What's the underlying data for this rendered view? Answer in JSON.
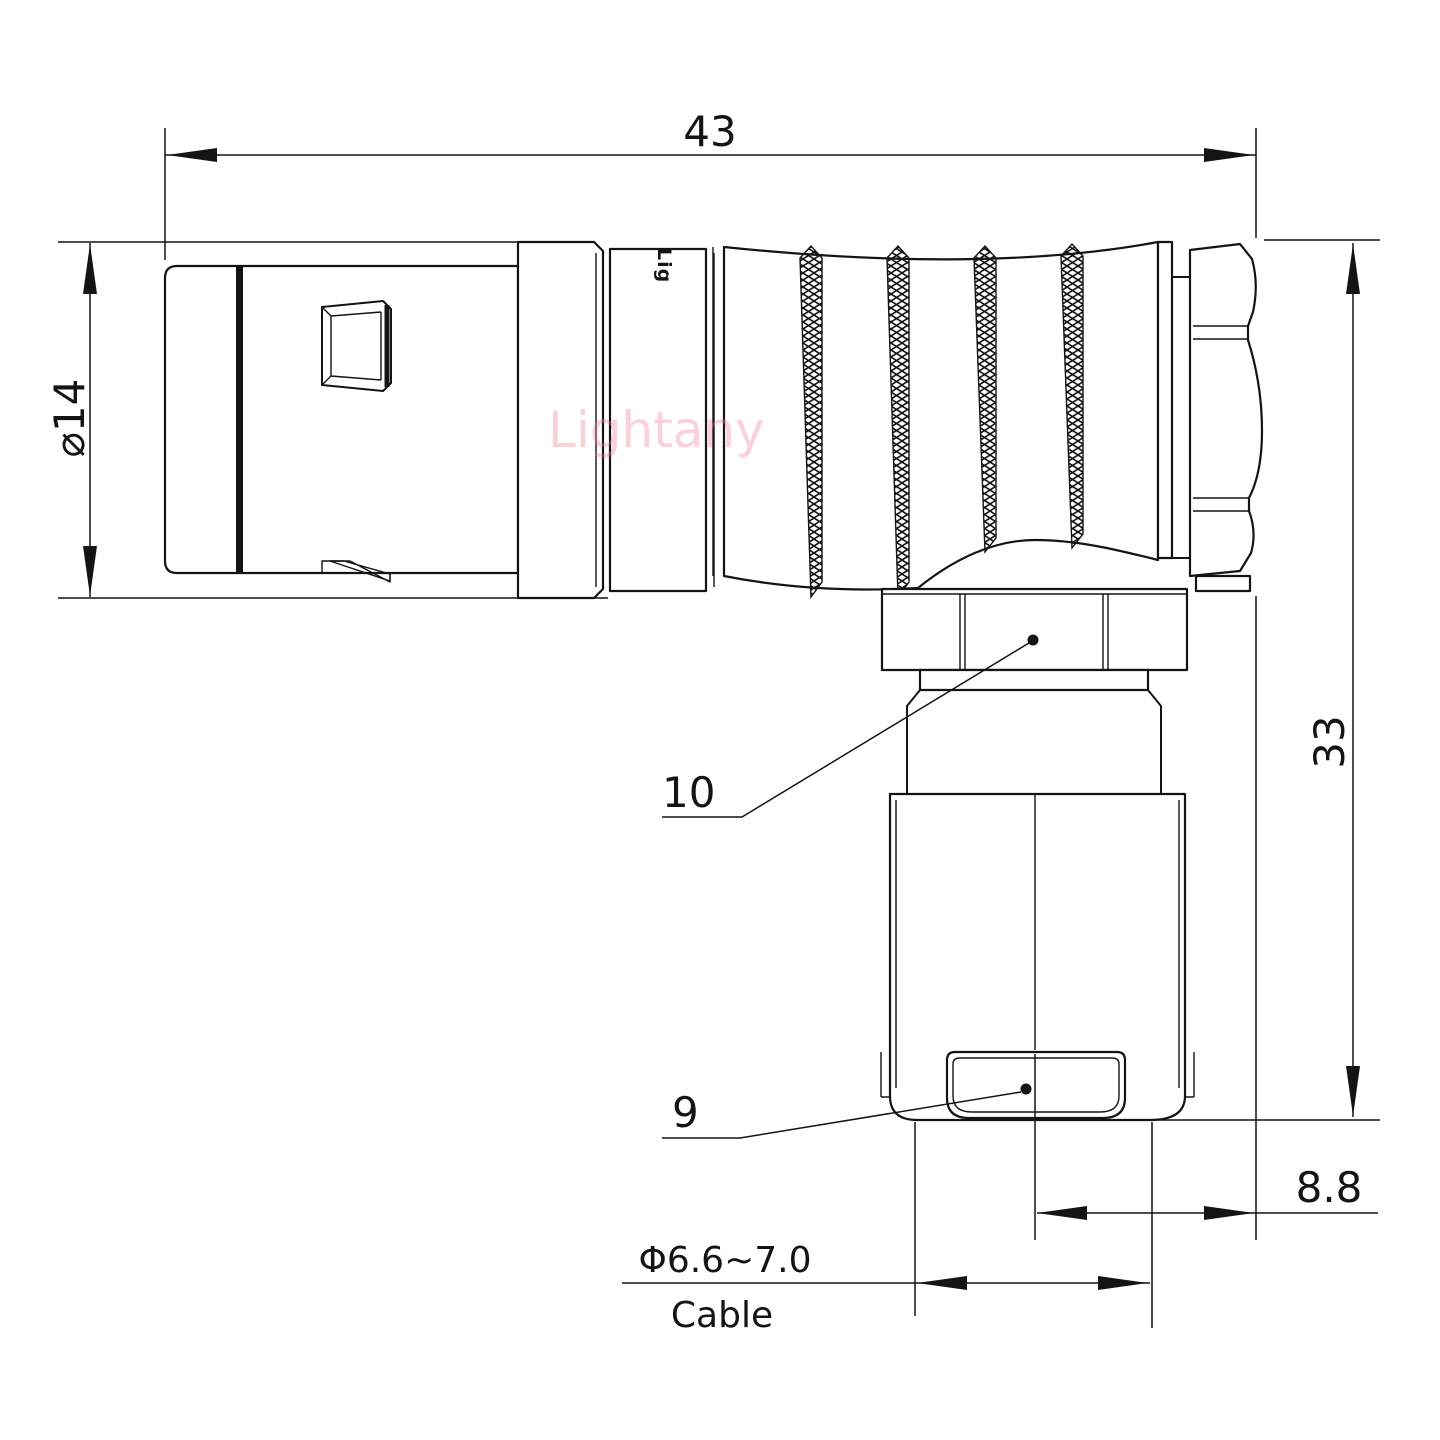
{
  "page": {
    "background": "#ffffff",
    "line_color": "#141414"
  },
  "watermark": {
    "text": "Lightany",
    "color": "#ee7d95"
  },
  "engraving": {
    "text": "Lig"
  },
  "dimensions": {
    "overall_length": "43",
    "body_diameter": "⌀14",
    "overall_height": "33",
    "rear_offset": "8.8",
    "cable_diameter_range": "Φ6.6~7.0",
    "cable_label": "Cable",
    "callout_nut": "10",
    "callout_clamp": "9"
  }
}
